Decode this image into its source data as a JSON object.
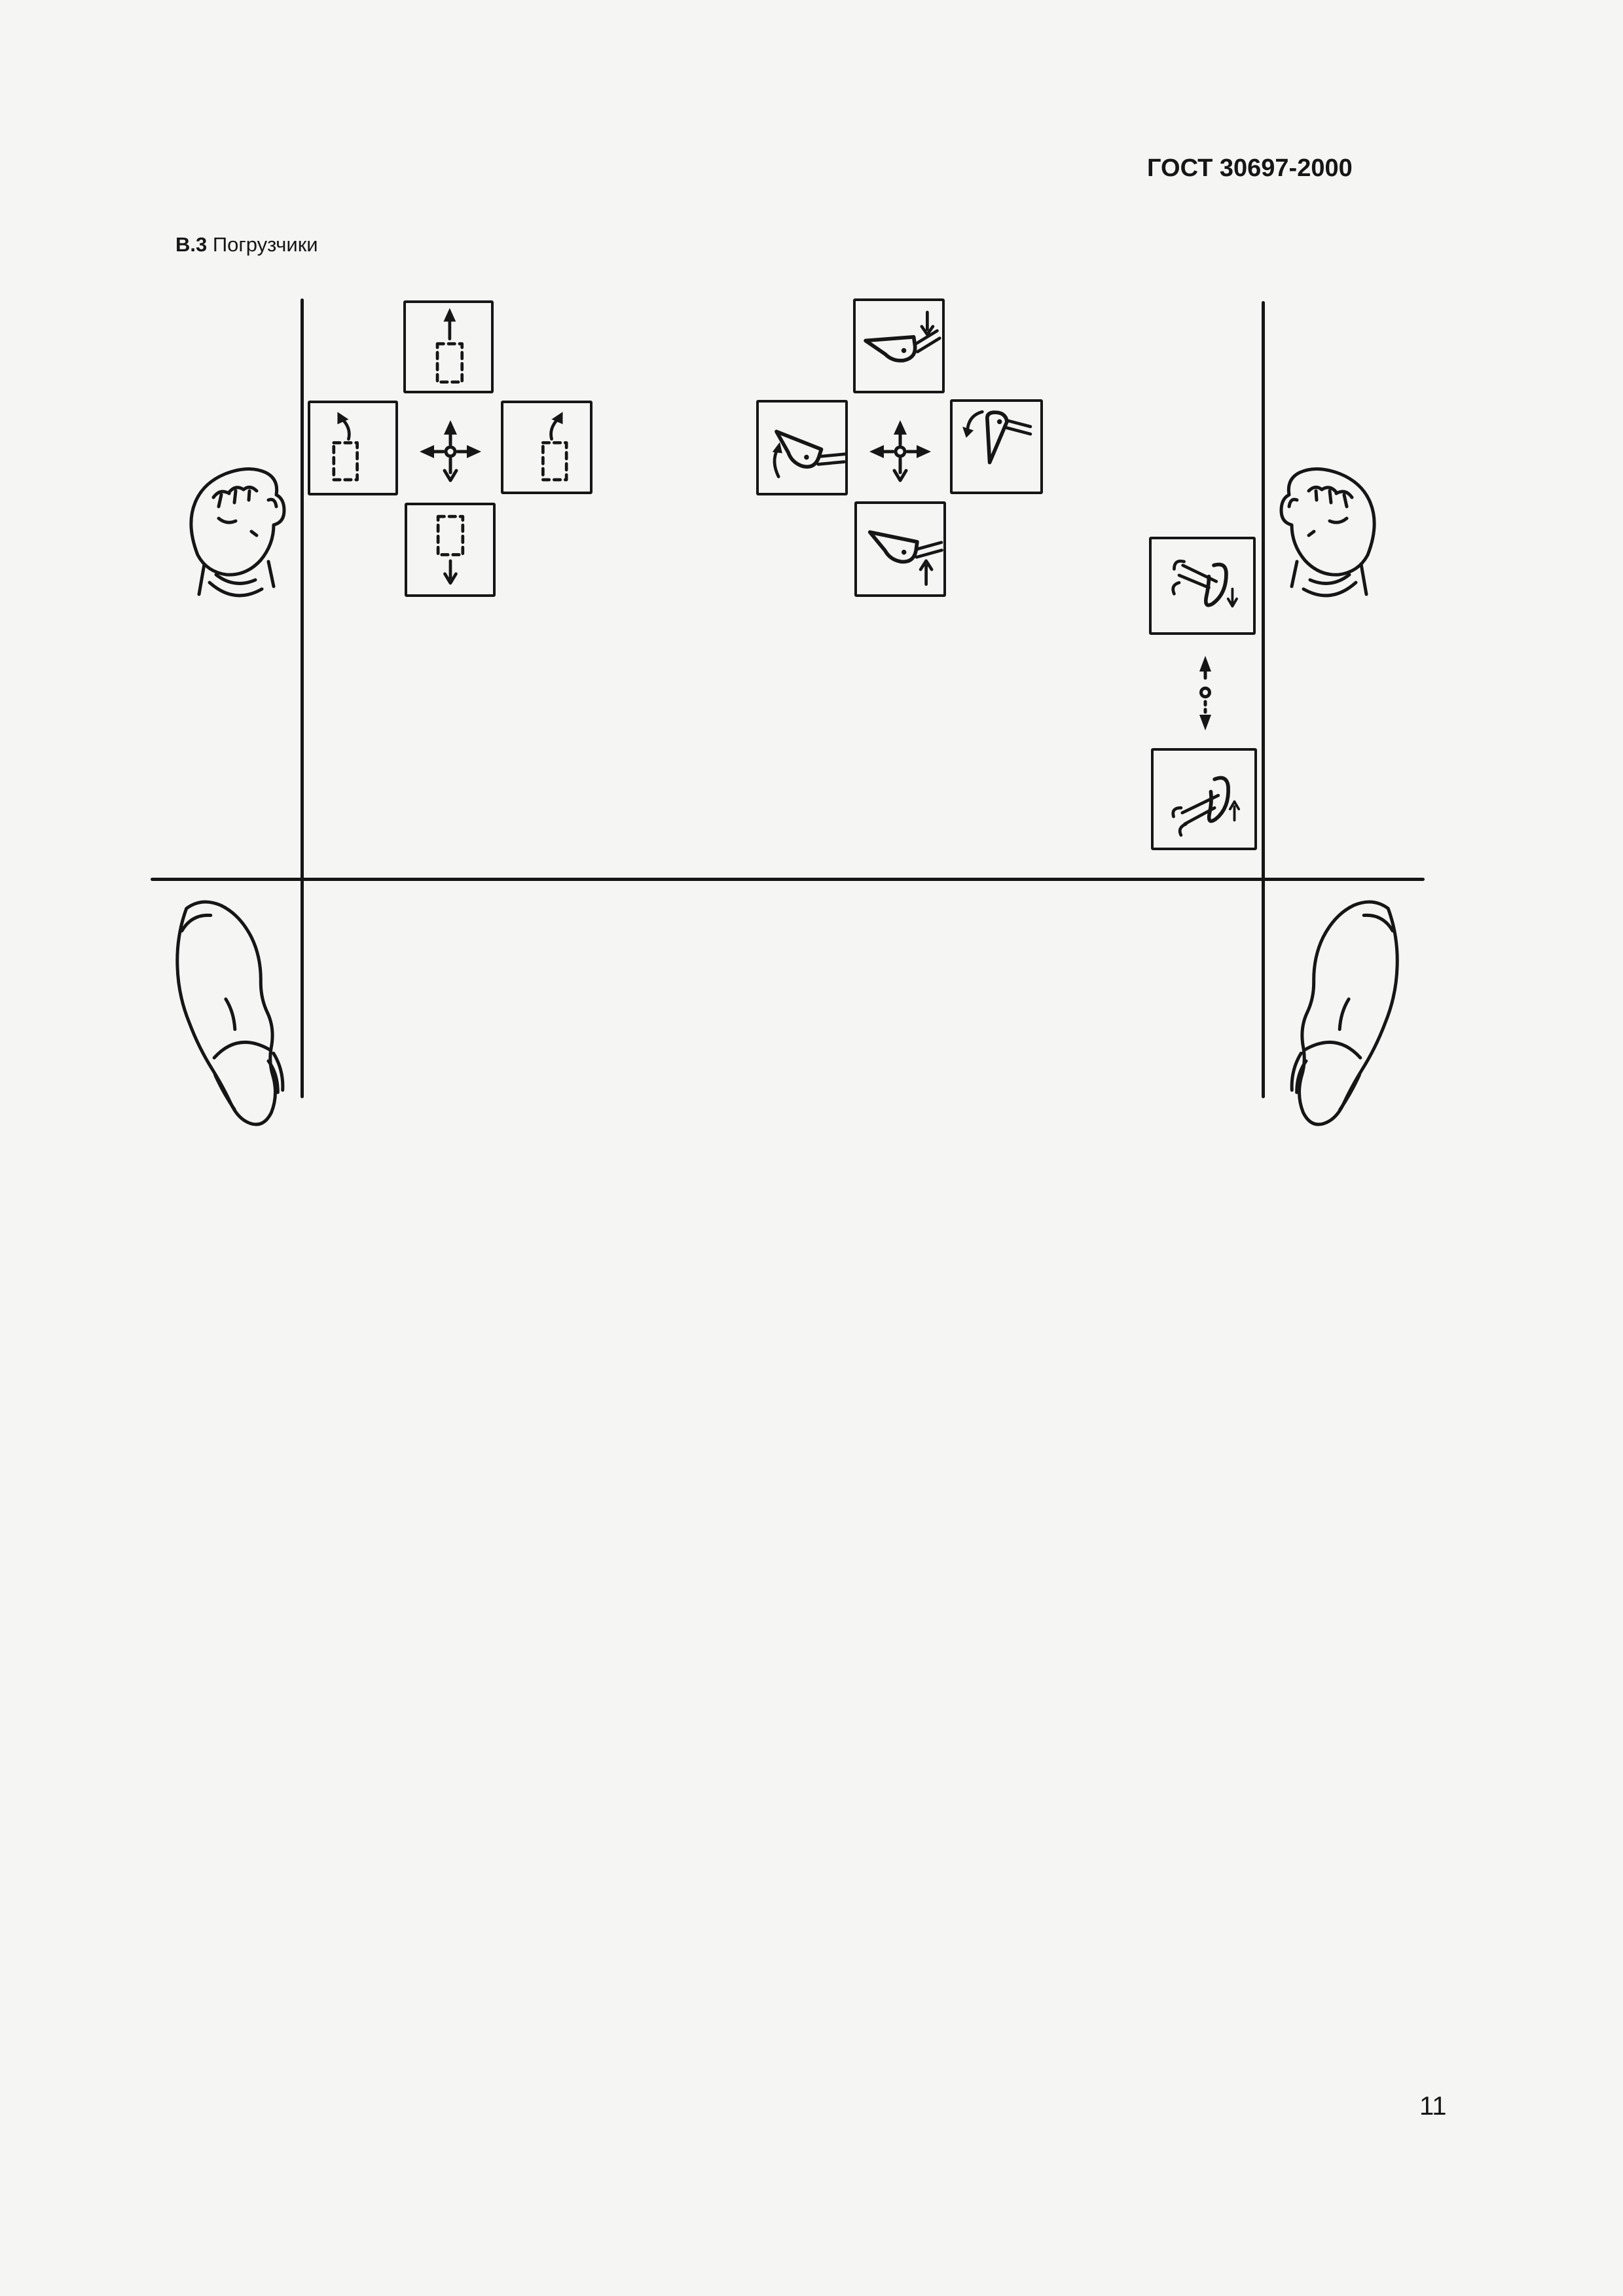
{
  "page": {
    "header": "ГОСТ 30697-2000",
    "section_number": "В.3",
    "section_title": "Погрузчики",
    "page_number": "11"
  },
  "colors": {
    "ink": "#161616",
    "paper": "#f5f5f4"
  },
  "diagram": {
    "description": "Operator-station control layout for loaders: hand levers between two side rails, foot positions below floor line",
    "left_hand": "left-fist",
    "right_hand": "right-fist",
    "left_foot": "left-boot",
    "right_foot": "right-boot",
    "left_cluster": {
      "center_icon": "four-way-arrows-icon",
      "boxes": [
        {
          "position": "top",
          "icon": "dashed-rect-arrow-up-icon"
        },
        {
          "position": "left",
          "icon": "dashed-rect-arrow-up-left-icon"
        },
        {
          "position": "right",
          "icon": "dashed-rect-arrow-up-right-icon"
        },
        {
          "position": "bottom",
          "icon": "dashed-rect-arrow-down-icon"
        }
      ]
    },
    "right_cluster": {
      "center_icon": "four-way-arrows-icon",
      "boxes": [
        {
          "position": "top",
          "icon": "bucket-lower-icon"
        },
        {
          "position": "left",
          "icon": "bucket-tilt-back-icon"
        },
        {
          "position": "right",
          "icon": "bucket-dump-icon"
        },
        {
          "position": "bottom",
          "icon": "bucket-raise-icon"
        }
      ]
    },
    "outrigger_pair": {
      "top_icon": "outrigger-lower-icon",
      "connector_icon": "two-way-vertical-arrow-icon",
      "bottom_icon": "outrigger-raise-icon"
    }
  }
}
